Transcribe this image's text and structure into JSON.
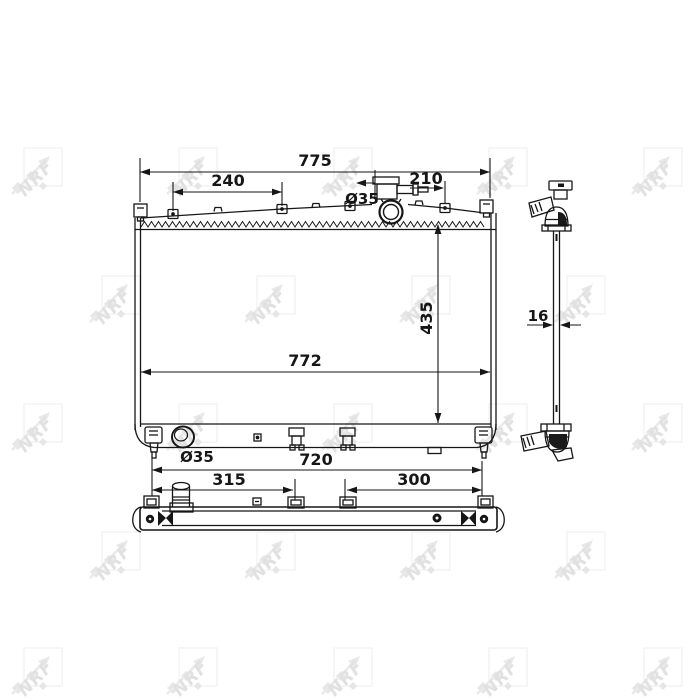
{
  "watermark": {
    "text": "NRF",
    "color": "#cdcdcd"
  },
  "line_color": "#161616",
  "dimensions": {
    "overall_width": "775",
    "upper_left_span": "240",
    "upper_right_span": "210",
    "filler_neck_diameter": "Ø35",
    "core_height": "435",
    "core_width": "772",
    "drain_port_diameter": "Ø35",
    "lower_span": "720",
    "lower_left_span": "315",
    "lower_right_span": "300",
    "core_thickness": "16"
  }
}
